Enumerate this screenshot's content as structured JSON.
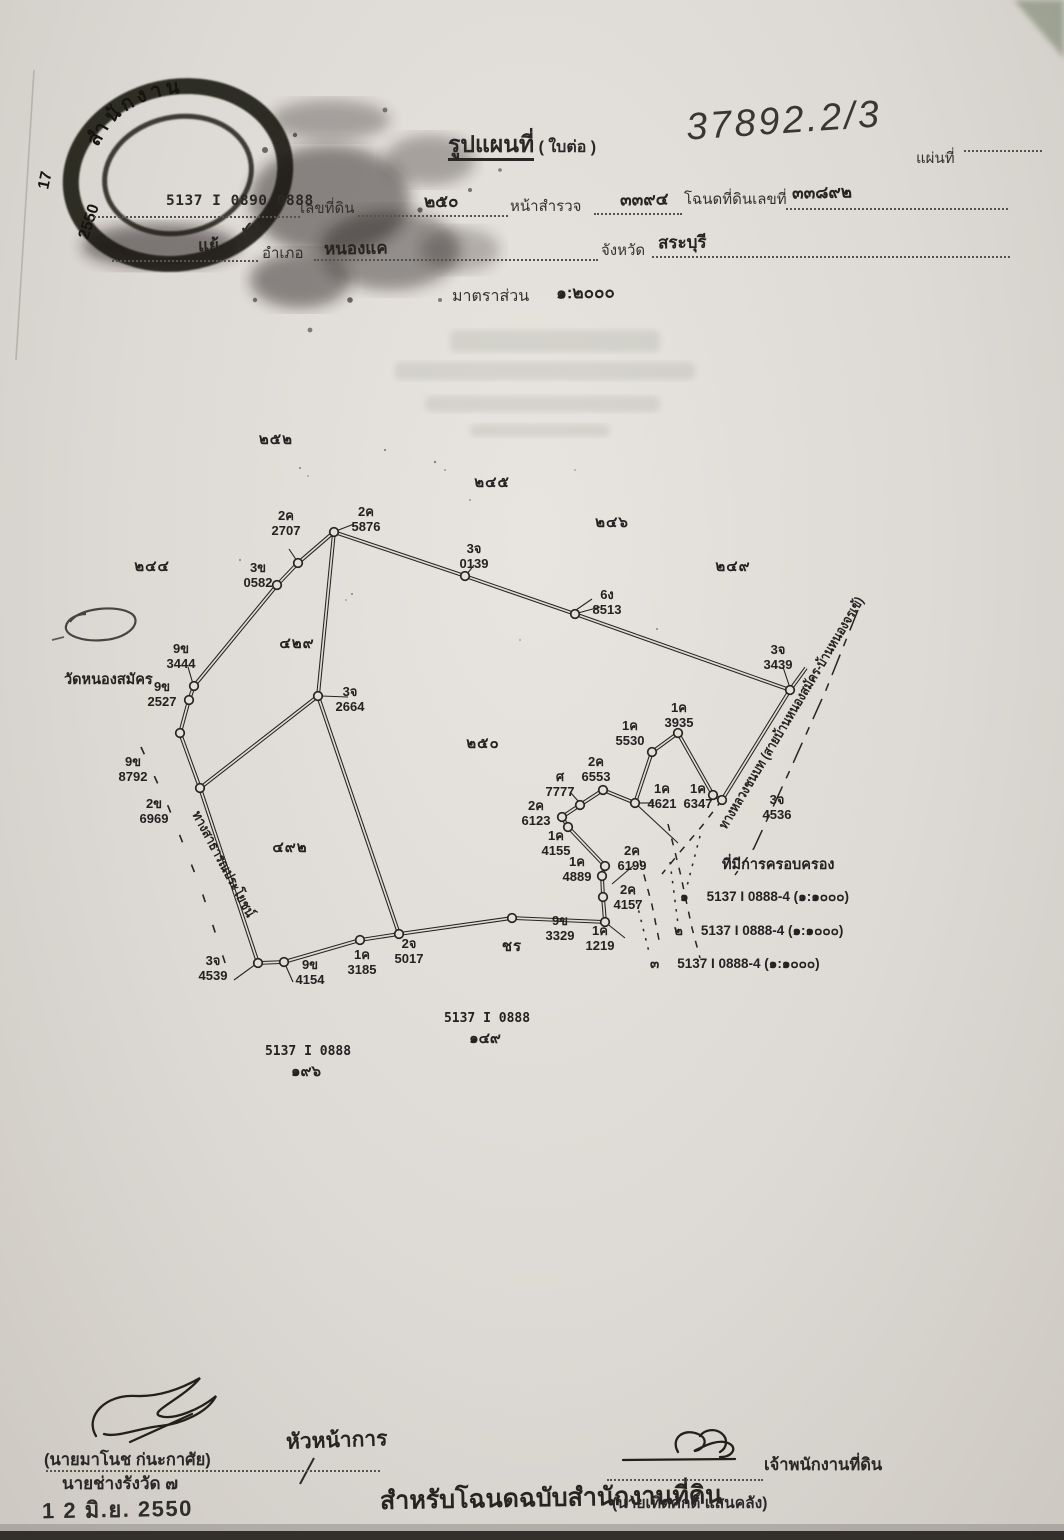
{
  "header": {
    "title": "รูปแผนที่",
    "title_paren": "( ใบต่อ )",
    "doc_number_handwritten": "37892.2/3",
    "sheet_no_label": "แผ่นที่",
    "map_sheet_code": "5137 I 0890 0888",
    "parcel_no_label": "เลขที่ดิน",
    "parcel_no": "๒๕๐",
    "survey_page_label": "หน้าสำรวจ",
    "survey_page": "๓๓๙๔",
    "deed_no_label": "โฉนดที่ดินเลขที่",
    "deed_no": "๓๓๘๙๒",
    "subdistrict_visible": "แย้",
    "district_label": "อำเภอ",
    "district": "หนองแค",
    "province_label": "จังหวัด",
    "province": "สระบุรี",
    "scale_label": "มาตราส่วน",
    "scale_value": "๑:๒๐๐๐",
    "check_mark": "✓"
  },
  "stamp": {
    "arc_text": "สำนักงาน",
    "number": "17",
    "year": "2550"
  },
  "map": {
    "temple_label": "วัดหนองสมัคร",
    "road_public": "ทางสาธารณประโยชน์",
    "road_rural": "ทางหลวงชนบท (สายบ้านหนองสมัคร-บ้านหนองจรเข้)",
    "possession_label": "ที่มีการครอบครอง",
    "area_labels": [
      {
        "t": "๒๕๒",
        "x": 276,
        "y": 444
      },
      {
        "t": "๒๔๕",
        "x": 492,
        "y": 487
      },
      {
        "t": "๒๔๖",
        "x": 612,
        "y": 527
      },
      {
        "t": "๒๔๔",
        "x": 152,
        "y": 571
      },
      {
        "t": "๒๔๙",
        "x": 733,
        "y": 571
      },
      {
        "t": "๔๒๙",
        "x": 297,
        "y": 648
      },
      {
        "t": "๒๕๐",
        "x": 483,
        "y": 748
      },
      {
        "t": "๔๙๒",
        "x": 290,
        "y": 852
      },
      {
        "t": "ชร",
        "x": 512,
        "y": 951
      }
    ],
    "point_labels": [
      {
        "c": "2ค",
        "n": "2707",
        "x": 286,
        "y": 520
      },
      {
        "c": "2ค",
        "n": "5876",
        "x": 366,
        "y": 516
      },
      {
        "c": "3จ",
        "n": "0139",
        "x": 474,
        "y": 553
      },
      {
        "c": "3ข",
        "n": "0582",
        "x": 258,
        "y": 572
      },
      {
        "c": "6ง",
        "n": "8513",
        "x": 607,
        "y": 599
      },
      {
        "c": "9ข",
        "n": "3444",
        "x": 181,
        "y": 653
      },
      {
        "c": "9ข",
        "n": "2527",
        "x": 162,
        "y": 691
      },
      {
        "c": "3จ",
        "n": "2664",
        "x": 350,
        "y": 696
      },
      {
        "c": "3จ",
        "n": "3439",
        "x": 778,
        "y": 654
      },
      {
        "c": "9ข",
        "n": "8792",
        "x": 133,
        "y": 766
      },
      {
        "c": "2ข",
        "n": "6969",
        "x": 154,
        "y": 808
      },
      {
        "c": "1ค",
        "n": "3935",
        "x": 679,
        "y": 712
      },
      {
        "c": "1ค",
        "n": "5530",
        "x": 630,
        "y": 730
      },
      {
        "c": "2ค",
        "n": "6553",
        "x": 596,
        "y": 766
      },
      {
        "c": "ศ",
        "n": "7777",
        "x": 560,
        "y": 781
      },
      {
        "c": "2ค",
        "n": "6123",
        "x": 536,
        "y": 810
      },
      {
        "c": "1ค",
        "n": "4155",
        "x": 556,
        "y": 840
      },
      {
        "c": "1ค",
        "n": "4621",
        "x": 662,
        "y": 793
      },
      {
        "c": "1ค",
        "n": "6347",
        "x": 698,
        "y": 793
      },
      {
        "c": "2ค",
        "n": "6199",
        "x": 632,
        "y": 855
      },
      {
        "c": "1ค",
        "n": "4889",
        "x": 577,
        "y": 866
      },
      {
        "c": "2ค",
        "n": "4157",
        "x": 628,
        "y": 894
      },
      {
        "c": "3จ",
        "n": "4536",
        "x": 777,
        "y": 804
      },
      {
        "c": "9ข",
        "n": "3329",
        "x": 560,
        "y": 925
      },
      {
        "c": "1ค",
        "n": "1219",
        "x": 600,
        "y": 935
      },
      {
        "c": "2จ",
        "n": "5017",
        "x": 409,
        "y": 948
      },
      {
        "c": "1ค",
        "n": "3185",
        "x": 362,
        "y": 959
      },
      {
        "c": "9ข",
        "n": "4154",
        "x": 310,
        "y": 969
      },
      {
        "c": "3จ",
        "n": "4539",
        "x": 213,
        "y": 965
      }
    ],
    "vertices": [
      [
        334,
        532
      ],
      [
        298,
        563
      ],
      [
        277,
        585
      ],
      [
        194,
        686
      ],
      [
        189,
        700
      ],
      [
        180,
        733
      ],
      [
        200,
        788
      ],
      [
        318,
        696
      ],
      [
        465,
        576
      ],
      [
        575,
        614
      ],
      [
        790,
        690
      ],
      [
        258,
        963
      ],
      [
        284,
        962
      ],
      [
        360,
        940
      ],
      [
        399,
        934
      ],
      [
        512,
        918
      ],
      [
        605,
        922
      ],
      [
        603,
        897
      ],
      [
        602,
        876
      ],
      [
        605,
        866
      ],
      [
        568,
        827
      ],
      [
        562,
        817
      ],
      [
        580,
        805
      ],
      [
        603,
        790
      ],
      [
        635,
        803
      ],
      [
        652,
        752
      ],
      [
        678,
        733
      ],
      [
        713,
        795
      ],
      [
        722,
        800
      ]
    ],
    "paths": [
      {
        "s": "double",
        "pts": [
          [
            334,
            532
          ],
          [
            298,
            563
          ],
          [
            277,
            585
          ],
          [
            194,
            686
          ],
          [
            189,
            700
          ],
          [
            180,
            733
          ],
          [
            200,
            788
          ],
          [
            258,
            963
          ]
        ]
      },
      {
        "s": "double",
        "pts": [
          [
            258,
            963
          ],
          [
            284,
            962
          ],
          [
            360,
            940
          ],
          [
            399,
            934
          ],
          [
            512,
            918
          ],
          [
            605,
            922
          ]
        ]
      },
      {
        "s": "double",
        "pts": [
          [
            605,
            922
          ],
          [
            603,
            897
          ],
          [
            602,
            876
          ],
          [
            605,
            866
          ],
          [
            568,
            827
          ],
          [
            562,
            817
          ],
          [
            580,
            805
          ],
          [
            603,
            790
          ],
          [
            635,
            803
          ],
          [
            652,
            752
          ],
          [
            678,
            733
          ],
          [
            713,
            795
          ],
          [
            722,
            800
          ]
        ]
      },
      {
        "s": "double",
        "pts": [
          [
            334,
            532
          ],
          [
            465,
            576
          ],
          [
            575,
            614
          ],
          [
            790,
            690
          ]
        ]
      },
      {
        "s": "double",
        "pts": [
          [
            806,
            668
          ],
          [
            790,
            690
          ],
          [
            722,
            800
          ]
        ]
      },
      {
        "s": "double",
        "pts": [
          [
            318,
            696
          ],
          [
            399,
            934
          ]
        ]
      },
      {
        "s": "double",
        "pts": [
          [
            200,
            788
          ],
          [
            318,
            696
          ],
          [
            334,
            532
          ]
        ]
      }
    ],
    "leaders": [
      [
        [
          289,
          549
        ],
        [
          297,
          561
        ]
      ],
      [
        [
          354,
          524
        ],
        [
          336,
          531
        ]
      ],
      [
        [
          474,
          565
        ],
        [
          467,
          574
        ]
      ],
      [
        [
          600,
          607
        ],
        [
          578,
          613
        ]
      ],
      [
        [
          592,
          599
        ],
        [
          576,
          610
        ]
      ],
      [
        [
          188,
          667
        ],
        [
          193,
          684
        ]
      ],
      [
        [
          783,
          667
        ],
        [
          790,
          688
        ]
      ],
      [
        [
          633,
          866
        ],
        [
          612,
          884
        ]
      ],
      [
        [
          654,
          803
        ],
        [
          639,
          803
        ]
      ],
      [
        [
          293,
          982
        ],
        [
          285,
          964
        ]
      ],
      [
        [
          234,
          980
        ],
        [
          256,
          964
        ]
      ],
      [
        [
          605,
          922
        ],
        [
          625,
          938
        ]
      ],
      [
        [
          635,
          803
        ],
        [
          678,
          843
        ]
      ],
      [
        [
          348,
          697
        ],
        [
          321,
          696
        ]
      ],
      [
        [
          570,
          792
        ],
        [
          579,
          802
        ]
      ]
    ],
    "dashes": [
      {
        "s": "dashw",
        "pts": [
          [
            141,
            747
          ],
          [
            168,
            806
          ],
          [
            200,
            886
          ],
          [
            232,
            984
          ]
        ]
      },
      {
        "s": "dashdot",
        "pts": [
          [
            858,
            610
          ],
          [
            826,
            690
          ],
          [
            790,
            770
          ],
          [
            754,
            848
          ],
          [
            735,
            875
          ]
        ]
      },
      {
        "s": "dash2",
        "pts": [
          [
            722,
            800
          ],
          [
            702,
            826
          ],
          [
            680,
            852
          ],
          [
            662,
            874
          ]
        ]
      },
      {
        "s": "dash2",
        "pts": [
          [
            668,
            824
          ],
          [
            680,
            872
          ],
          [
            692,
            928
          ],
          [
            700,
            958
          ]
        ]
      },
      {
        "s": "dash2",
        "pts": [
          [
            640,
            860
          ],
          [
            652,
            905
          ],
          [
            660,
            945
          ]
        ]
      },
      {
        "s": "dot",
        "pts": [
          [
            700,
            836
          ],
          [
            686,
            890
          ]
        ]
      },
      {
        "s": "dot",
        "pts": [
          [
            670,
            862
          ],
          [
            678,
            924
          ]
        ]
      },
      {
        "s": "dot",
        "pts": [
          [
            634,
            892
          ],
          [
            650,
            956
          ]
        ]
      }
    ],
    "texts": [
      {
        "t": "วัดหนองสมัคร",
        "x": 64,
        "y": 684,
        "cls": "tl",
        "anchor": "start",
        "name": "temple-label"
      },
      {
        "t": "ที่มีการครอบครอง",
        "x": 722,
        "y": 869,
        "cls": "pos",
        "anchor": "start",
        "name": "possession-label"
      }
    ],
    "rot": [
      {
        "t": "ทางสาธารณประโยชน์",
        "x": 192,
        "y": 814,
        "a": 62,
        "len": 118,
        "name": "public-road-label"
      },
      {
        "t": "ทางหลวงชนบท (สายบ้านหนองสมัคร-บ้านหนองจรเข้)",
        "x": 726,
        "y": 830,
        "a": -59,
        "len": 268,
        "name": "rural-road-label"
      }
    ],
    "refs": [
      {
        "l1": "5137 I 0888",
        "l2": "๑๔๙",
        "x": 487,
        "y": 1022
      },
      {
        "l1": "5137 I 0888",
        "l2": "๑๙๖",
        "x": 308,
        "y": 1055
      }
    ],
    "claims": [
      {
        "no": "๑",
        "text": "5137 I 0888-4 (๑:๑๐๐๐)",
        "x": 680,
        "y": 901
      },
      {
        "no": "๒",
        "text": "5137 I 0888-4 (๑:๑๐๐๐)",
        "x": 674,
        "y": 935
      },
      {
        "no": "๓",
        "text": "5137 I 0888-4 (๑:๑๐๐๐)",
        "x": 650,
        "y": 968
      }
    ]
  },
  "footer": {
    "left_name": "(นายมาโนช ก่นะกาศัย)",
    "left_title": "นายช่างรังวัด ๗",
    "left_approver_handwritten": "หัวหน้าการ",
    "date_stamp": "1 2 มิ.ย. 2550",
    "center_note": "สำหรับโฉนดฉบับสำนักงานที่ดิน",
    "right_title": "เจ้าพนักงานที่ดิน",
    "right_name": "(นายเทิดศักดิ์ แสนคลัง)"
  }
}
